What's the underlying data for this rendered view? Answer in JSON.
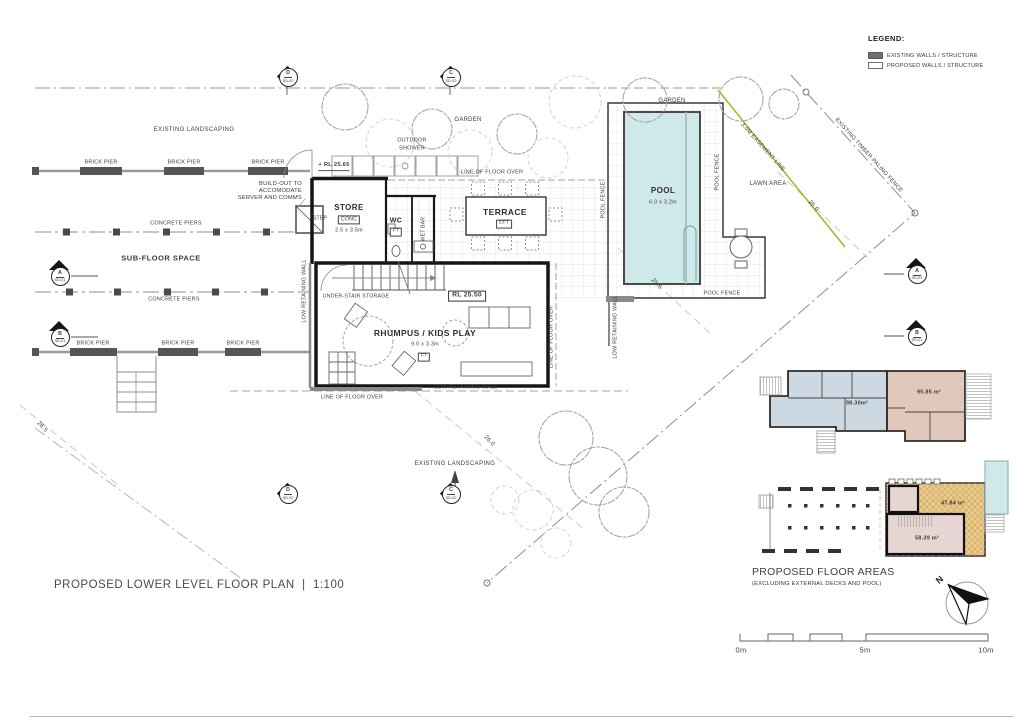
{
  "drawing": {
    "title": "PROPOSED LOWER LEVEL FLOOR PLAN",
    "separator": "|",
    "scale_text": "1:100"
  },
  "legend": {
    "heading": "LEGEND:",
    "existing": "EXISTING WALLS / STRUCTURE",
    "proposed": "PROPOSED WALLS / STRUCTURE"
  },
  "labels": {
    "existing_landscaping": "EXISTING LANDSCAPING",
    "brick_pier": "BRICK PIER",
    "concrete_piers": "CONCRETE PIERS",
    "sub_floor_space": "SUB-FLOOR SPACE",
    "build_out_1": "BUILD-OUT TO",
    "build_out_2": "ACCOMODATE",
    "build_out_3": "SERVER AND COMMS",
    "outdoor_shower_1": "OUTDOOR",
    "outdoor_shower_2": "SHOWER",
    "garden": "GARDEN",
    "lawn_area": "LAWN AREA",
    "easement": "3.0M EASEMENT LINE",
    "timber_fence": "EXISTING TIMBER PALING FENCE",
    "line_of_floor_over": "LINE OF FLOOR OVER",
    "low_retaining_wall": "LOW RETAINING WALL",
    "pool_fence": "POOL FENCE",
    "under_stair": "UNDER-STAIR STORAGE",
    "step": "STEP"
  },
  "rooms": {
    "store": {
      "name": "STORE",
      "finish": "CONC",
      "size": "2.5 x 3.5m"
    },
    "wc": {
      "name": "WC",
      "finish": "FT"
    },
    "wet_bar": "WET BAR",
    "terrace": {
      "name": "TERRACE",
      "finish": "EFT"
    },
    "rhumpus": {
      "name": "RHUMPUS / KIDS PLAY",
      "size": "9.0 x 3.3m",
      "finish": "FT"
    },
    "pool": {
      "name": "POOL",
      "size": "6.0 x 3.2m"
    }
  },
  "levels": {
    "rl_store": "+ RL 25.65",
    "rl_rhumpus": "RL 25.50"
  },
  "contours": {
    "c1": "26.5",
    "c2": "26.0",
    "c3": "25.5",
    "c4": "25.0"
  },
  "markers": {
    "a": {
      "letter": "A",
      "sheet": "SD-01"
    },
    "b": {
      "letter": "B",
      "sheet": "SD-01"
    },
    "c": {
      "letter": "C",
      "sheet": "SD-02"
    },
    "d": {
      "letter": "D",
      "sheet": "SD-02"
    }
  },
  "floor_areas": {
    "heading": "PROPOSED FLOOR AREAS",
    "subheading": "(EXCLUDING EXTERNAL DECKS AND POOL)",
    "upper_left_area": "98.30m²",
    "upper_right_area": "95.85 m²",
    "lower_deck_area": "47.84 m²",
    "lower_room_area": "58.39 m²"
  },
  "scale_bar": {
    "start": "0m",
    "mid": "5m",
    "end": "10m"
  },
  "compass": {
    "north": "N"
  },
  "colors": {
    "pool_water": "#cfe8ea",
    "inset_blue": "#ccd9e3",
    "inset_pink": "#e0c8bc",
    "inset_orange": "#e9c88b",
    "inset_room_pink": "#e7d5d3",
    "easement_line": "#b0b02a",
    "existing_wall": "#6e6e6e"
  }
}
